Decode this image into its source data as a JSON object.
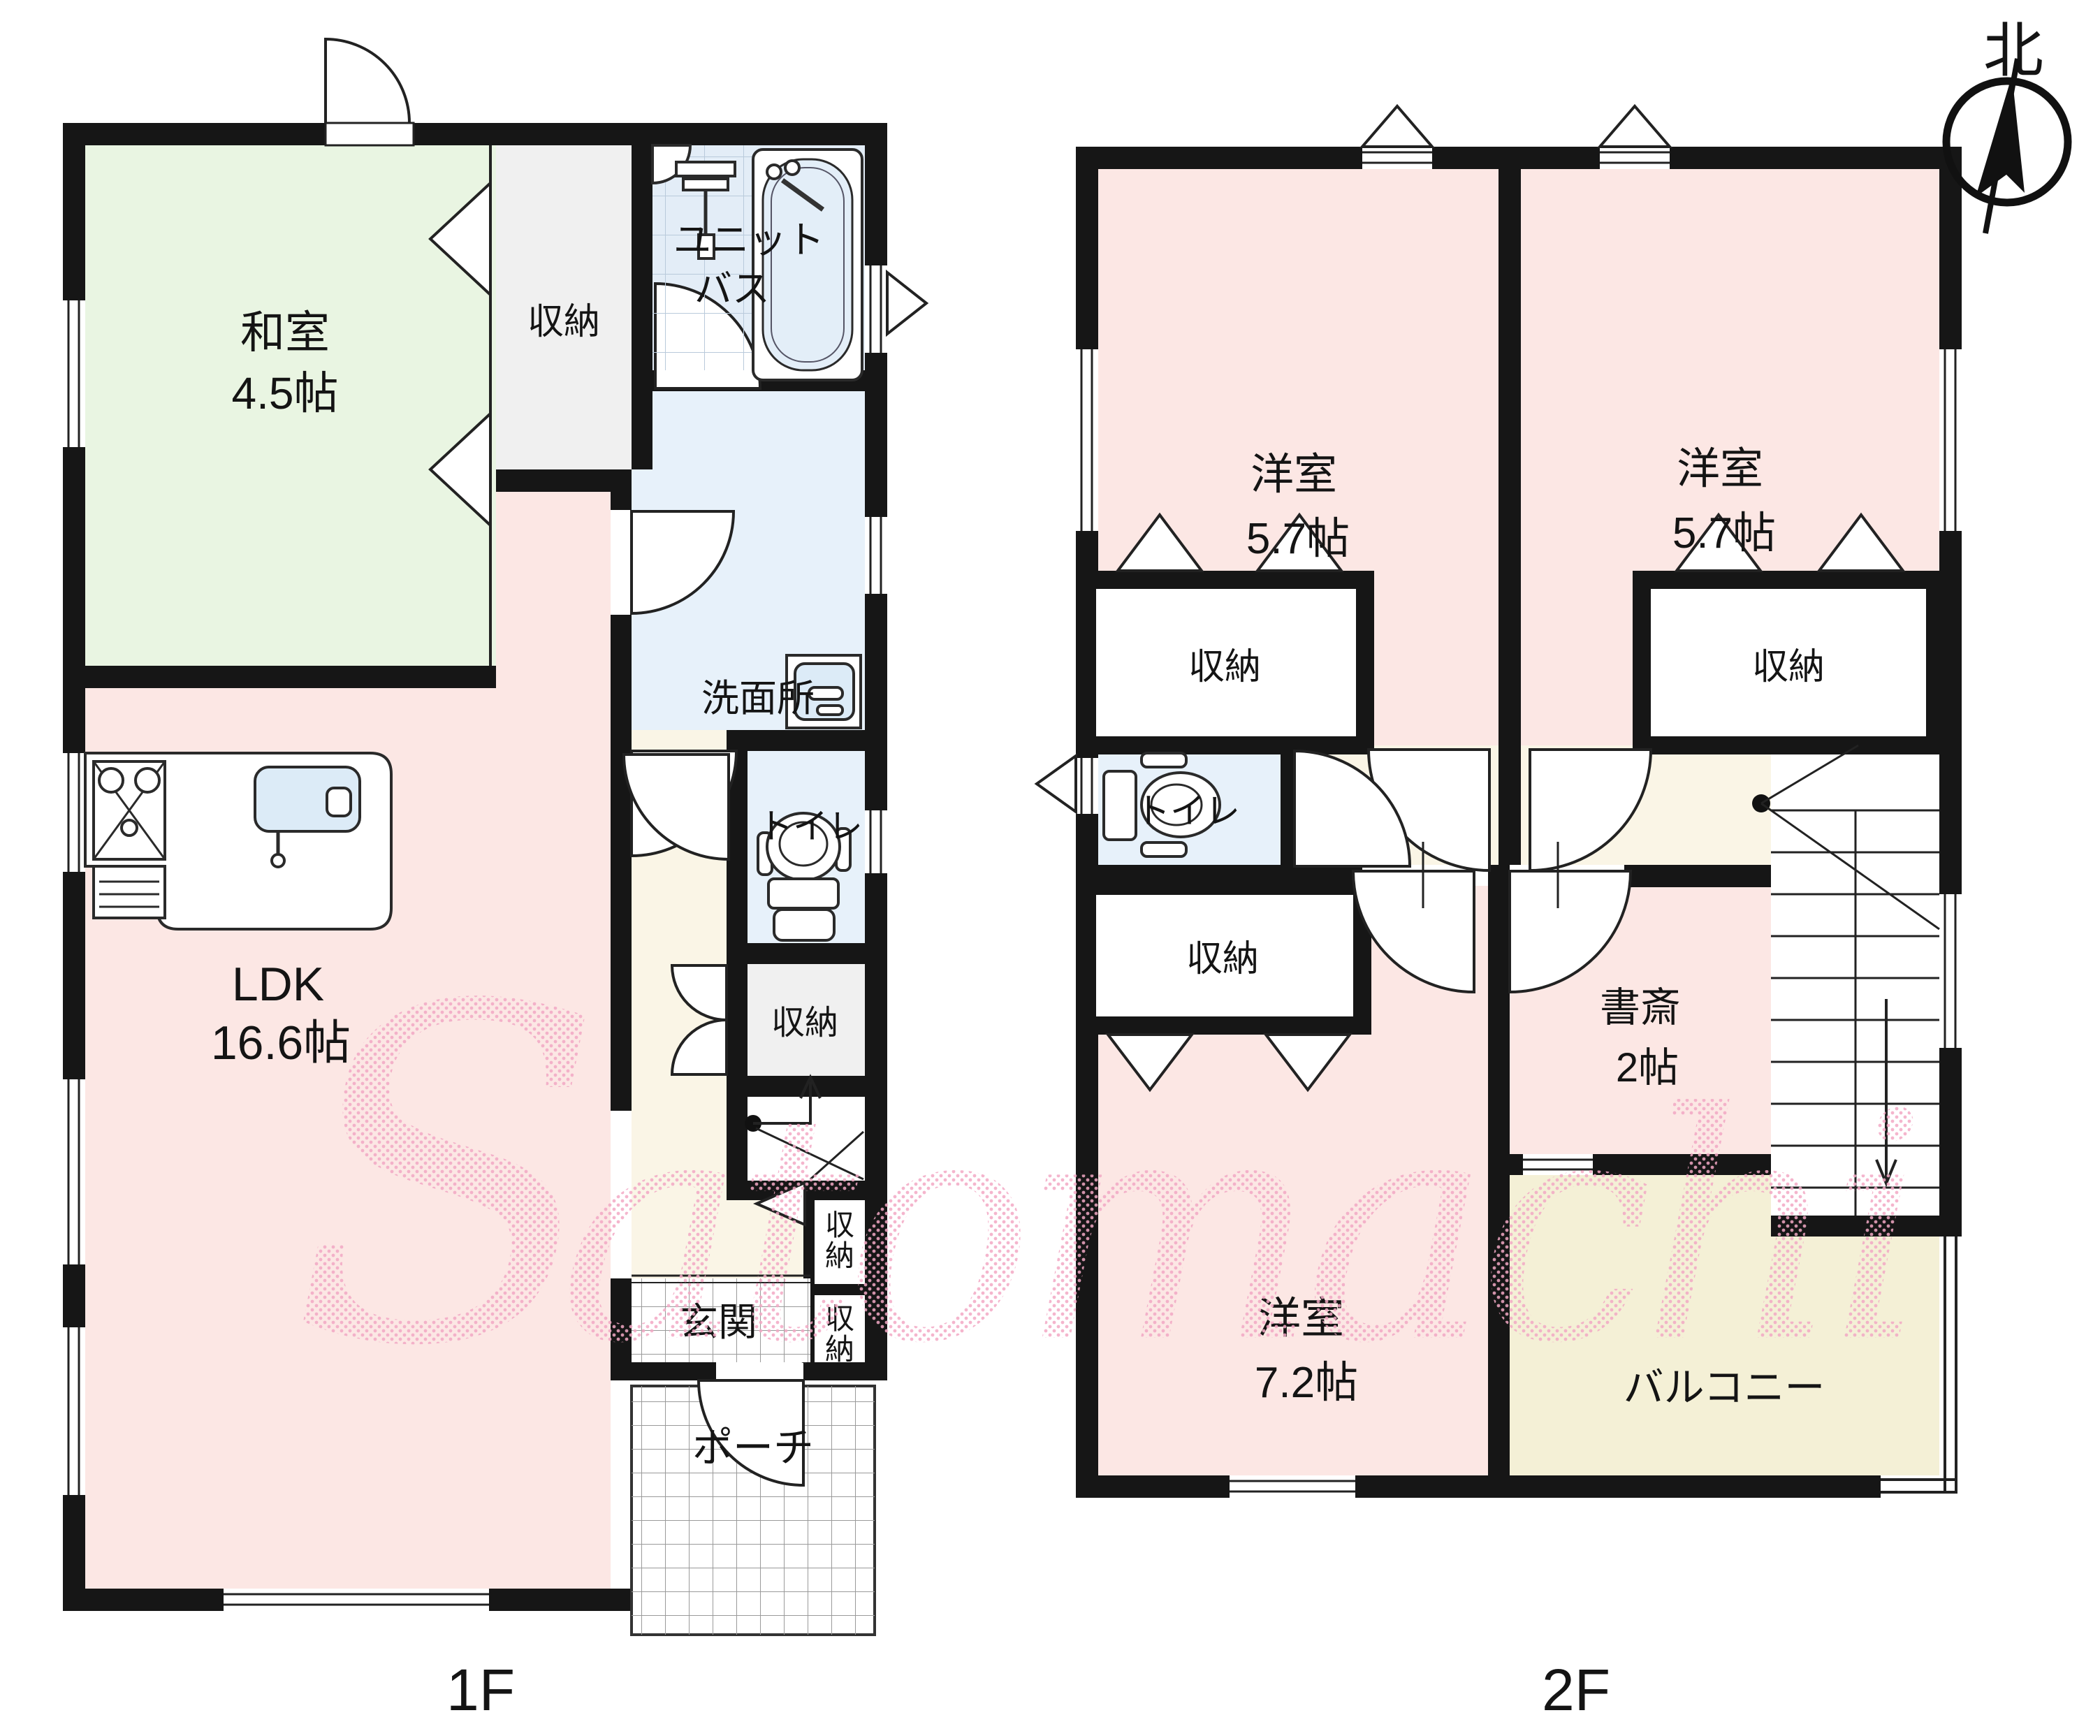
{
  "compass": {
    "label": "北"
  },
  "watermark": {
    "initial": "S",
    "rest": "atomachi"
  },
  "floor1": {
    "label": "1F",
    "washitsu_1": "和室",
    "washitsu_2": "4.5帖",
    "closet_a": "収納",
    "unitbath_1": "ユニット",
    "unitbath_2": "バス",
    "senmenjo": "洗面所",
    "toilet": "トイレ",
    "ldk_1": "LDK",
    "ldk_2": "16.6帖",
    "closet_b": "収納",
    "closet_c_1": "収",
    "closet_c_2": "納",
    "closet_d_1": "収",
    "closet_d_2": "納",
    "genkan": "玄関",
    "porch": "ポーチ"
  },
  "floor2": {
    "label": "2F",
    "yoshitsu_l_1": "洋室",
    "yoshitsu_l_2": "5.7帖",
    "yoshitsu_r_1": "洋室",
    "yoshitsu_r_2": "5.7帖",
    "closet_l": "収納",
    "closet_r": "収納",
    "toilet": "トイレ",
    "closet_c": "収納",
    "shosai_1": "書斎",
    "shosai_2": "2帖",
    "yoshitsu72_1": "洋室",
    "yoshitsu72_2": "7.2帖",
    "balcony": "バルコニー"
  },
  "colors": {
    "wall": "#161616",
    "tatami_room": "#e9f5e2",
    "western_room": "#fce7e4",
    "wet_room": "#e7f1fa",
    "bath_room": "#e3edf7",
    "hallway": "#faf5e6",
    "balcony": "#f4f0d6",
    "closet_gray": "#f0f0f0",
    "watermark_pink": "#f2a8c4"
  }
}
